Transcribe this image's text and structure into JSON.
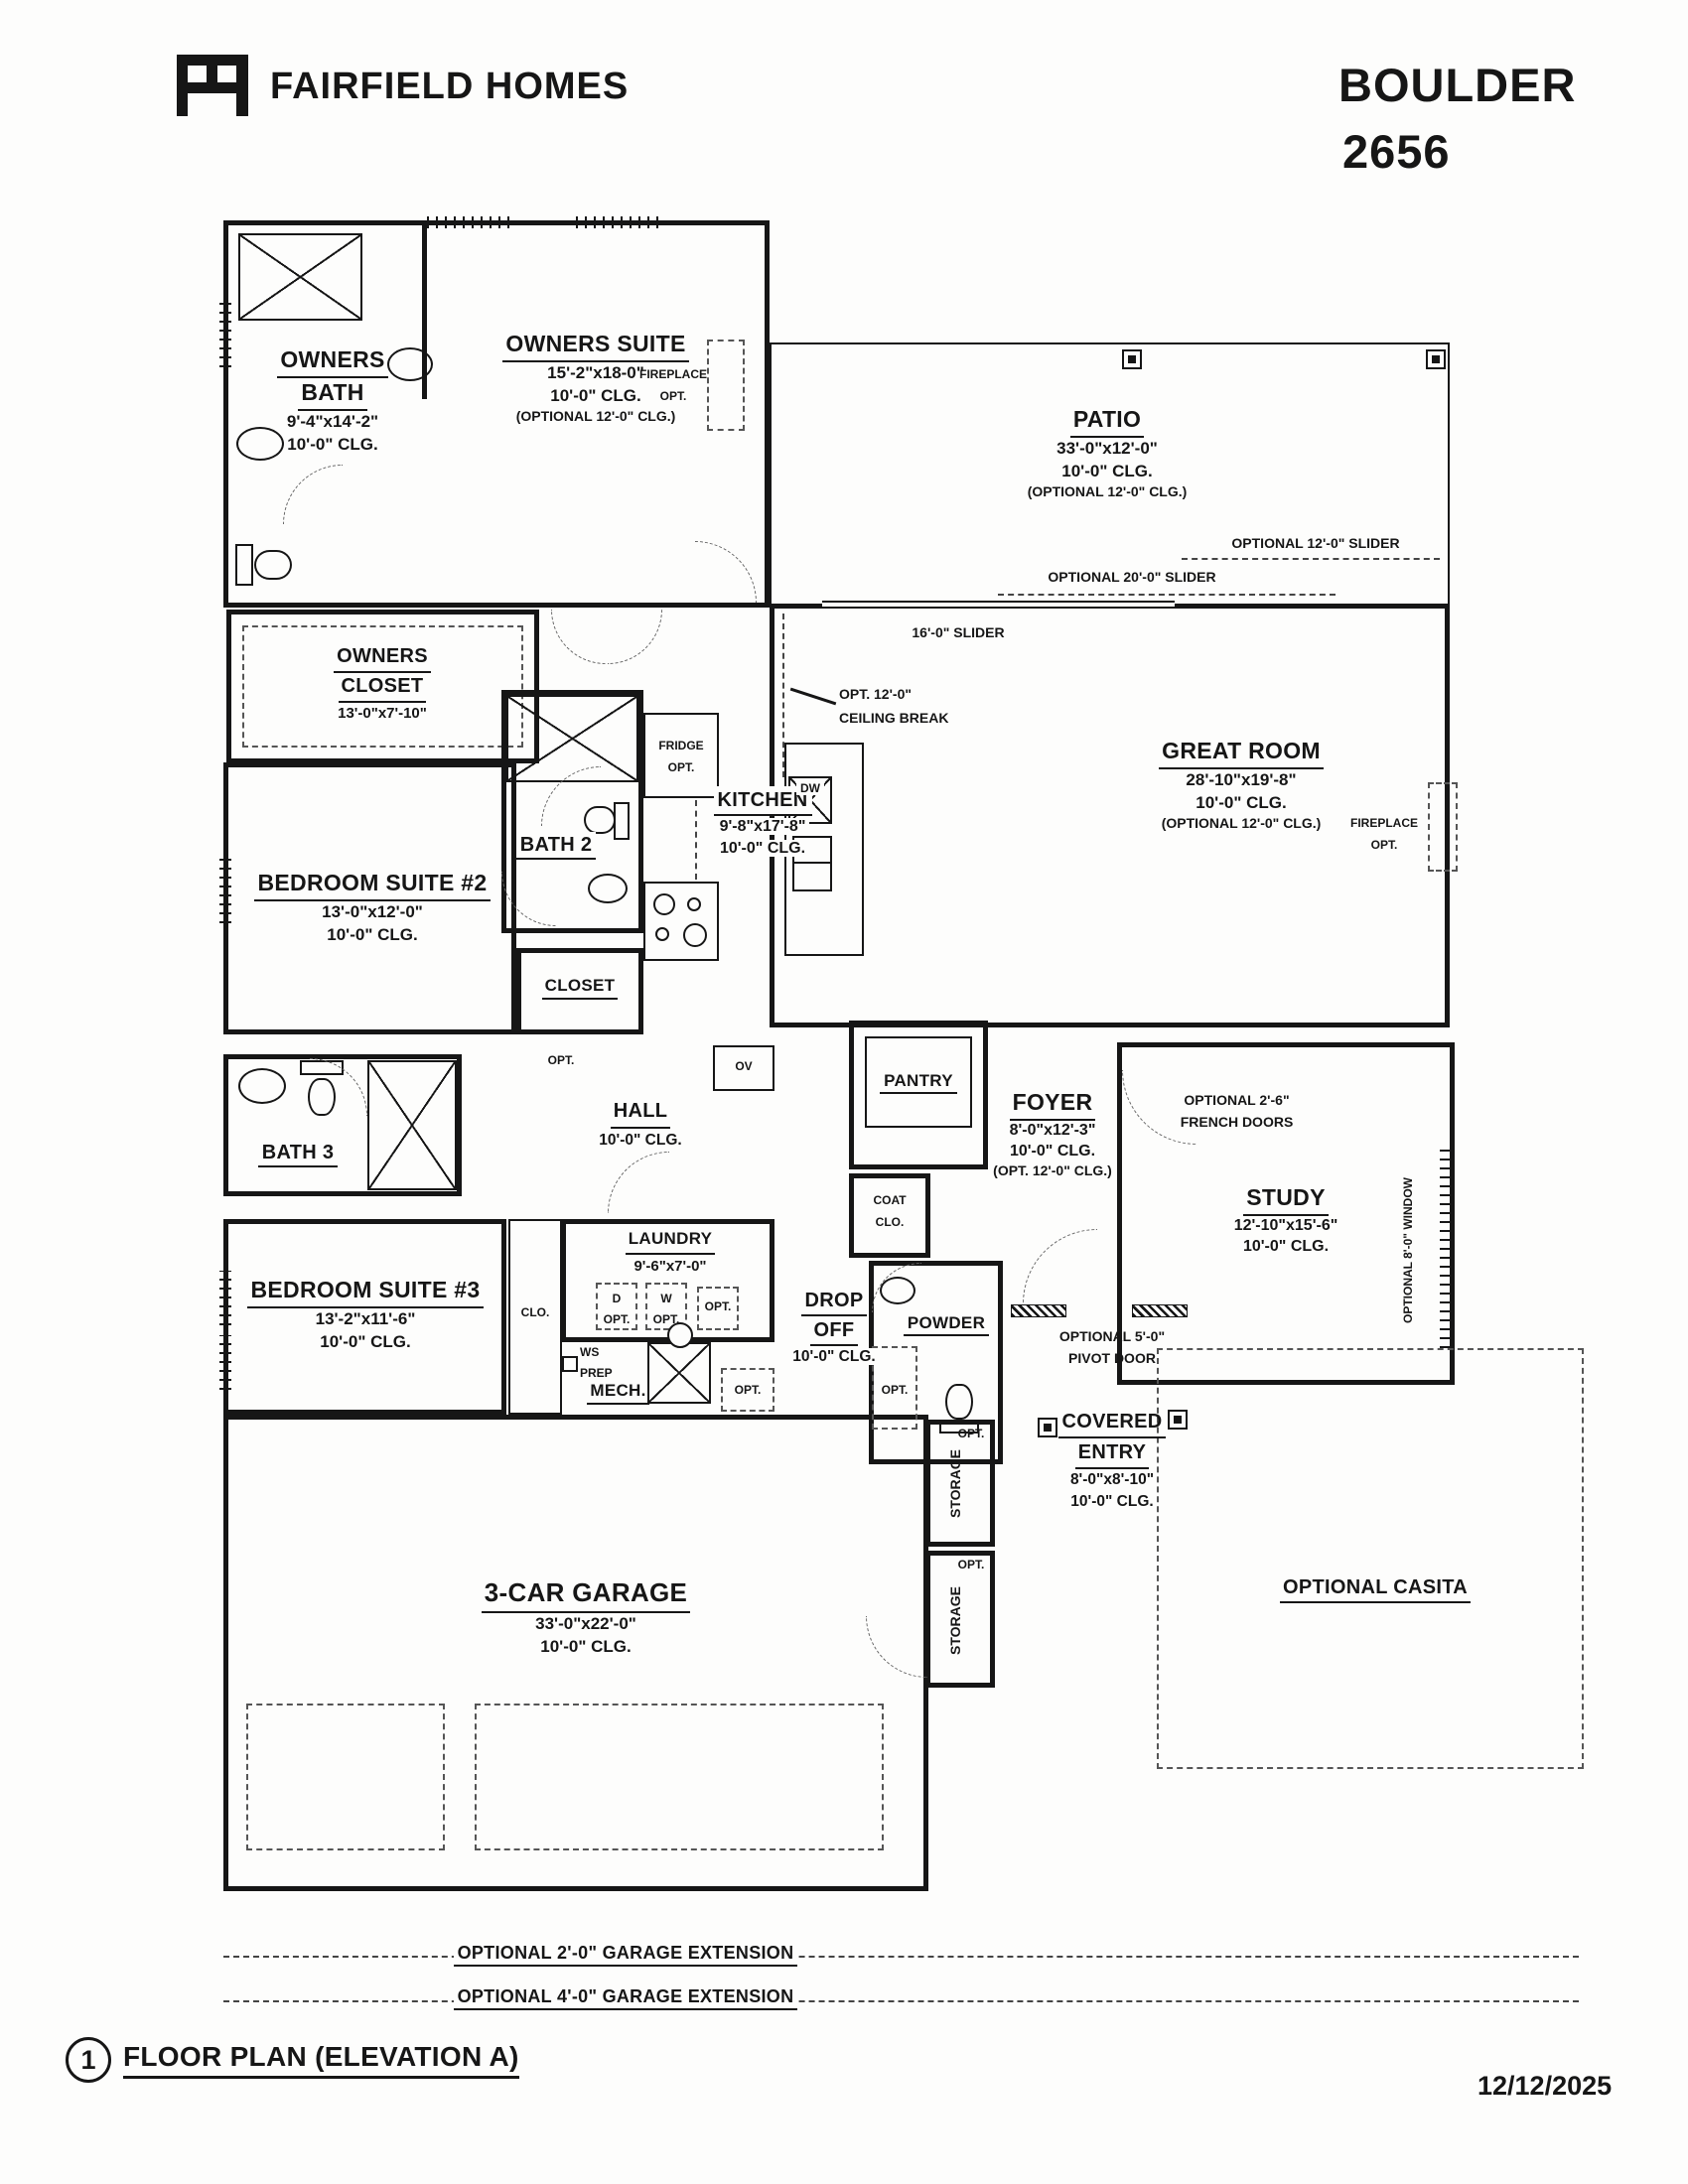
{
  "header": {
    "logo_monogram": "FH",
    "brand": "FAIRFIELD HOMES",
    "model_name": "BOULDER",
    "model_number": "2656"
  },
  "rooms": {
    "owners_bath": {
      "line1": "OWNERS",
      "line2": "BATH",
      "dims": "9'-4\"x14'-2\"",
      "clg": "10'-0\" CLG."
    },
    "owners_suite": {
      "name": "OWNERS SUITE",
      "dims": "15'-2\"x18-0\"",
      "clg": "10'-0\" CLG.",
      "opt": "(OPTIONAL 12'-0\" CLG.)"
    },
    "owners_closet": {
      "line1": "OWNERS",
      "line2": "CLOSET",
      "dims": "13'-0\"x7'-10\""
    },
    "patio": {
      "name": "PATIO",
      "dims": "33'-0\"x12'-0\"",
      "clg": "10'-0\" CLG.",
      "opt": "(OPTIONAL 12'-0\" CLG.)"
    },
    "great_room": {
      "name": "GREAT ROOM",
      "dims": "28'-10\"x19'-8\"",
      "clg": "10'-0\" CLG.",
      "opt": "(OPTIONAL 12'-0\" CLG.)"
    },
    "kitchen": {
      "name": "KITCHEN",
      "dims": "9'-8\"x17'-8\"",
      "clg": "10'-0\" CLG."
    },
    "bath2": {
      "name": "BATH 2"
    },
    "bedroom2": {
      "name": "BEDROOM SUITE #2",
      "dims": "13'-0\"x12'-0\"",
      "clg": "10'-0\" CLG."
    },
    "closet2": {
      "name": "CLOSET"
    },
    "bath3": {
      "name": "BATH 3"
    },
    "hall": {
      "name": "HALL",
      "clg": "10'-0\" CLG."
    },
    "pantry": {
      "name": "PANTRY"
    },
    "coat_closet": {
      "line1": "COAT",
      "line2": "CLO."
    },
    "foyer": {
      "name": "FOYER",
      "dims": "8'-0\"x12'-3\"",
      "clg": "10'-0\" CLG.",
      "opt": "(OPT. 12'-0\" CLG.)"
    },
    "study": {
      "name": "STUDY",
      "dims": "12'-10\"x15'-6\"",
      "clg": "10'-0\" CLG."
    },
    "bedroom3": {
      "name": "BEDROOM SUITE #3",
      "dims": "13'-2\"x11'-6\"",
      "clg": "10'-0\" CLG."
    },
    "closet3": {
      "name": "CLO."
    },
    "laundry": {
      "name": "LAUNDRY",
      "dims": "9'-6\"x7'-0\""
    },
    "mech": {
      "name": "MECH."
    },
    "drop_off": {
      "line1": "DROP",
      "line2": "OFF",
      "clg": "10'-0\" CLG."
    },
    "powder": {
      "name": "POWDER"
    },
    "covered_entry": {
      "line1": "COVERED",
      "line2": "ENTRY",
      "dims": "8'-0\"x8'-10\"",
      "clg": "10'-0\" CLG."
    },
    "garage": {
      "name": "3-CAR GARAGE",
      "dims": "33'-0\"x22'-0\"",
      "clg": "10'-0\" CLG."
    },
    "storage1": {
      "name": "STORAGE",
      "opt": "OPT."
    },
    "storage2": {
      "name": "STORAGE",
      "opt": "OPT."
    },
    "casita": {
      "name": "OPTIONAL CASITA"
    }
  },
  "annotations": {
    "fireplace": {
      "line1": "FIREPLACE",
      "line2": "OPT."
    },
    "slider12": "OPTIONAL 12'-0\" SLIDER",
    "slider20": "OPTIONAL 20'-0\" SLIDER",
    "slider16": "16'-0\" SLIDER",
    "ceiling_break": {
      "line1": "OPT. 12'-0\"",
      "line2": "CEILING BREAK"
    },
    "fridge": {
      "line1": "FRIDGE",
      "line2": "OPT."
    },
    "dw": "DW",
    "ov": "OV",
    "dryer": "D",
    "washer": "W",
    "opt": "OPT.",
    "ws_prep": {
      "line1": "WS",
      "line2": "PREP"
    },
    "french_doors": {
      "line1": "OPTIONAL 2'-6\"",
      "line2": "FRENCH DOORS"
    },
    "opt_window": "OPTIONAL 8'-0\" WINDOW",
    "pivot_door": {
      "line1": "OPTIONAL 5'-0\"",
      "line2": "PIVOT DOOR"
    },
    "garage_ext2": "OPTIONAL 2'-0\" GARAGE EXTENSION",
    "garage_ext4": "OPTIONAL 4'-0\" GARAGE EXTENSION"
  },
  "footer": {
    "sheet_number": "1",
    "title": "FLOOR PLAN (ELEVATION A)",
    "date": "12/12/2025"
  }
}
